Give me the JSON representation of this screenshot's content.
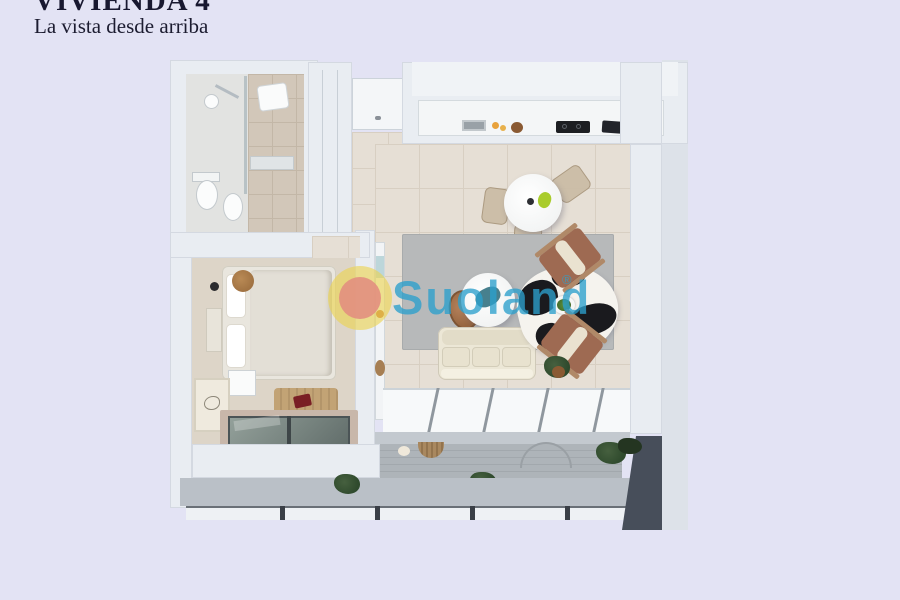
{
  "header": {
    "title": "VIVIENDA 4",
    "subtitle": "La vista desde arriba"
  },
  "watermark": {
    "brand": "Suoland",
    "registered_mark": "®"
  },
  "palette": {
    "page_background": "#e3e3f4",
    "wall_white": "#e9edf2",
    "outer_wall": "#dde2e9",
    "floor_tile_beige": "#e6dfd5",
    "bathroom_tile": "#d2c7b9",
    "bedroom_carpet": "#ddd5c8",
    "living_rug_gray": "#b7b9ba",
    "sofa_cream": "#ece7d6",
    "armchair_terracotta": "#9e6a52",
    "cowhide_black": "#1a1a1e",
    "skylight_glass": "#7e8d89",
    "terrace_deck_gray": "#aeb4b9",
    "terrace_shadow": "#474e5a",
    "plant_green": "#2f4a2d",
    "watermark_teal": "#2ca0cd",
    "logo_ring_yellow": "#ecd34f",
    "logo_dot_pink": "#e28f80",
    "title_ink": "#181830"
  },
  "floorplan": {
    "view": "top-down 3d render",
    "rooms": [
      "bathroom",
      "entry-hall",
      "wardrobe",
      "kitchen",
      "dining-area",
      "living-room",
      "bedroom",
      "terrace"
    ]
  }
}
